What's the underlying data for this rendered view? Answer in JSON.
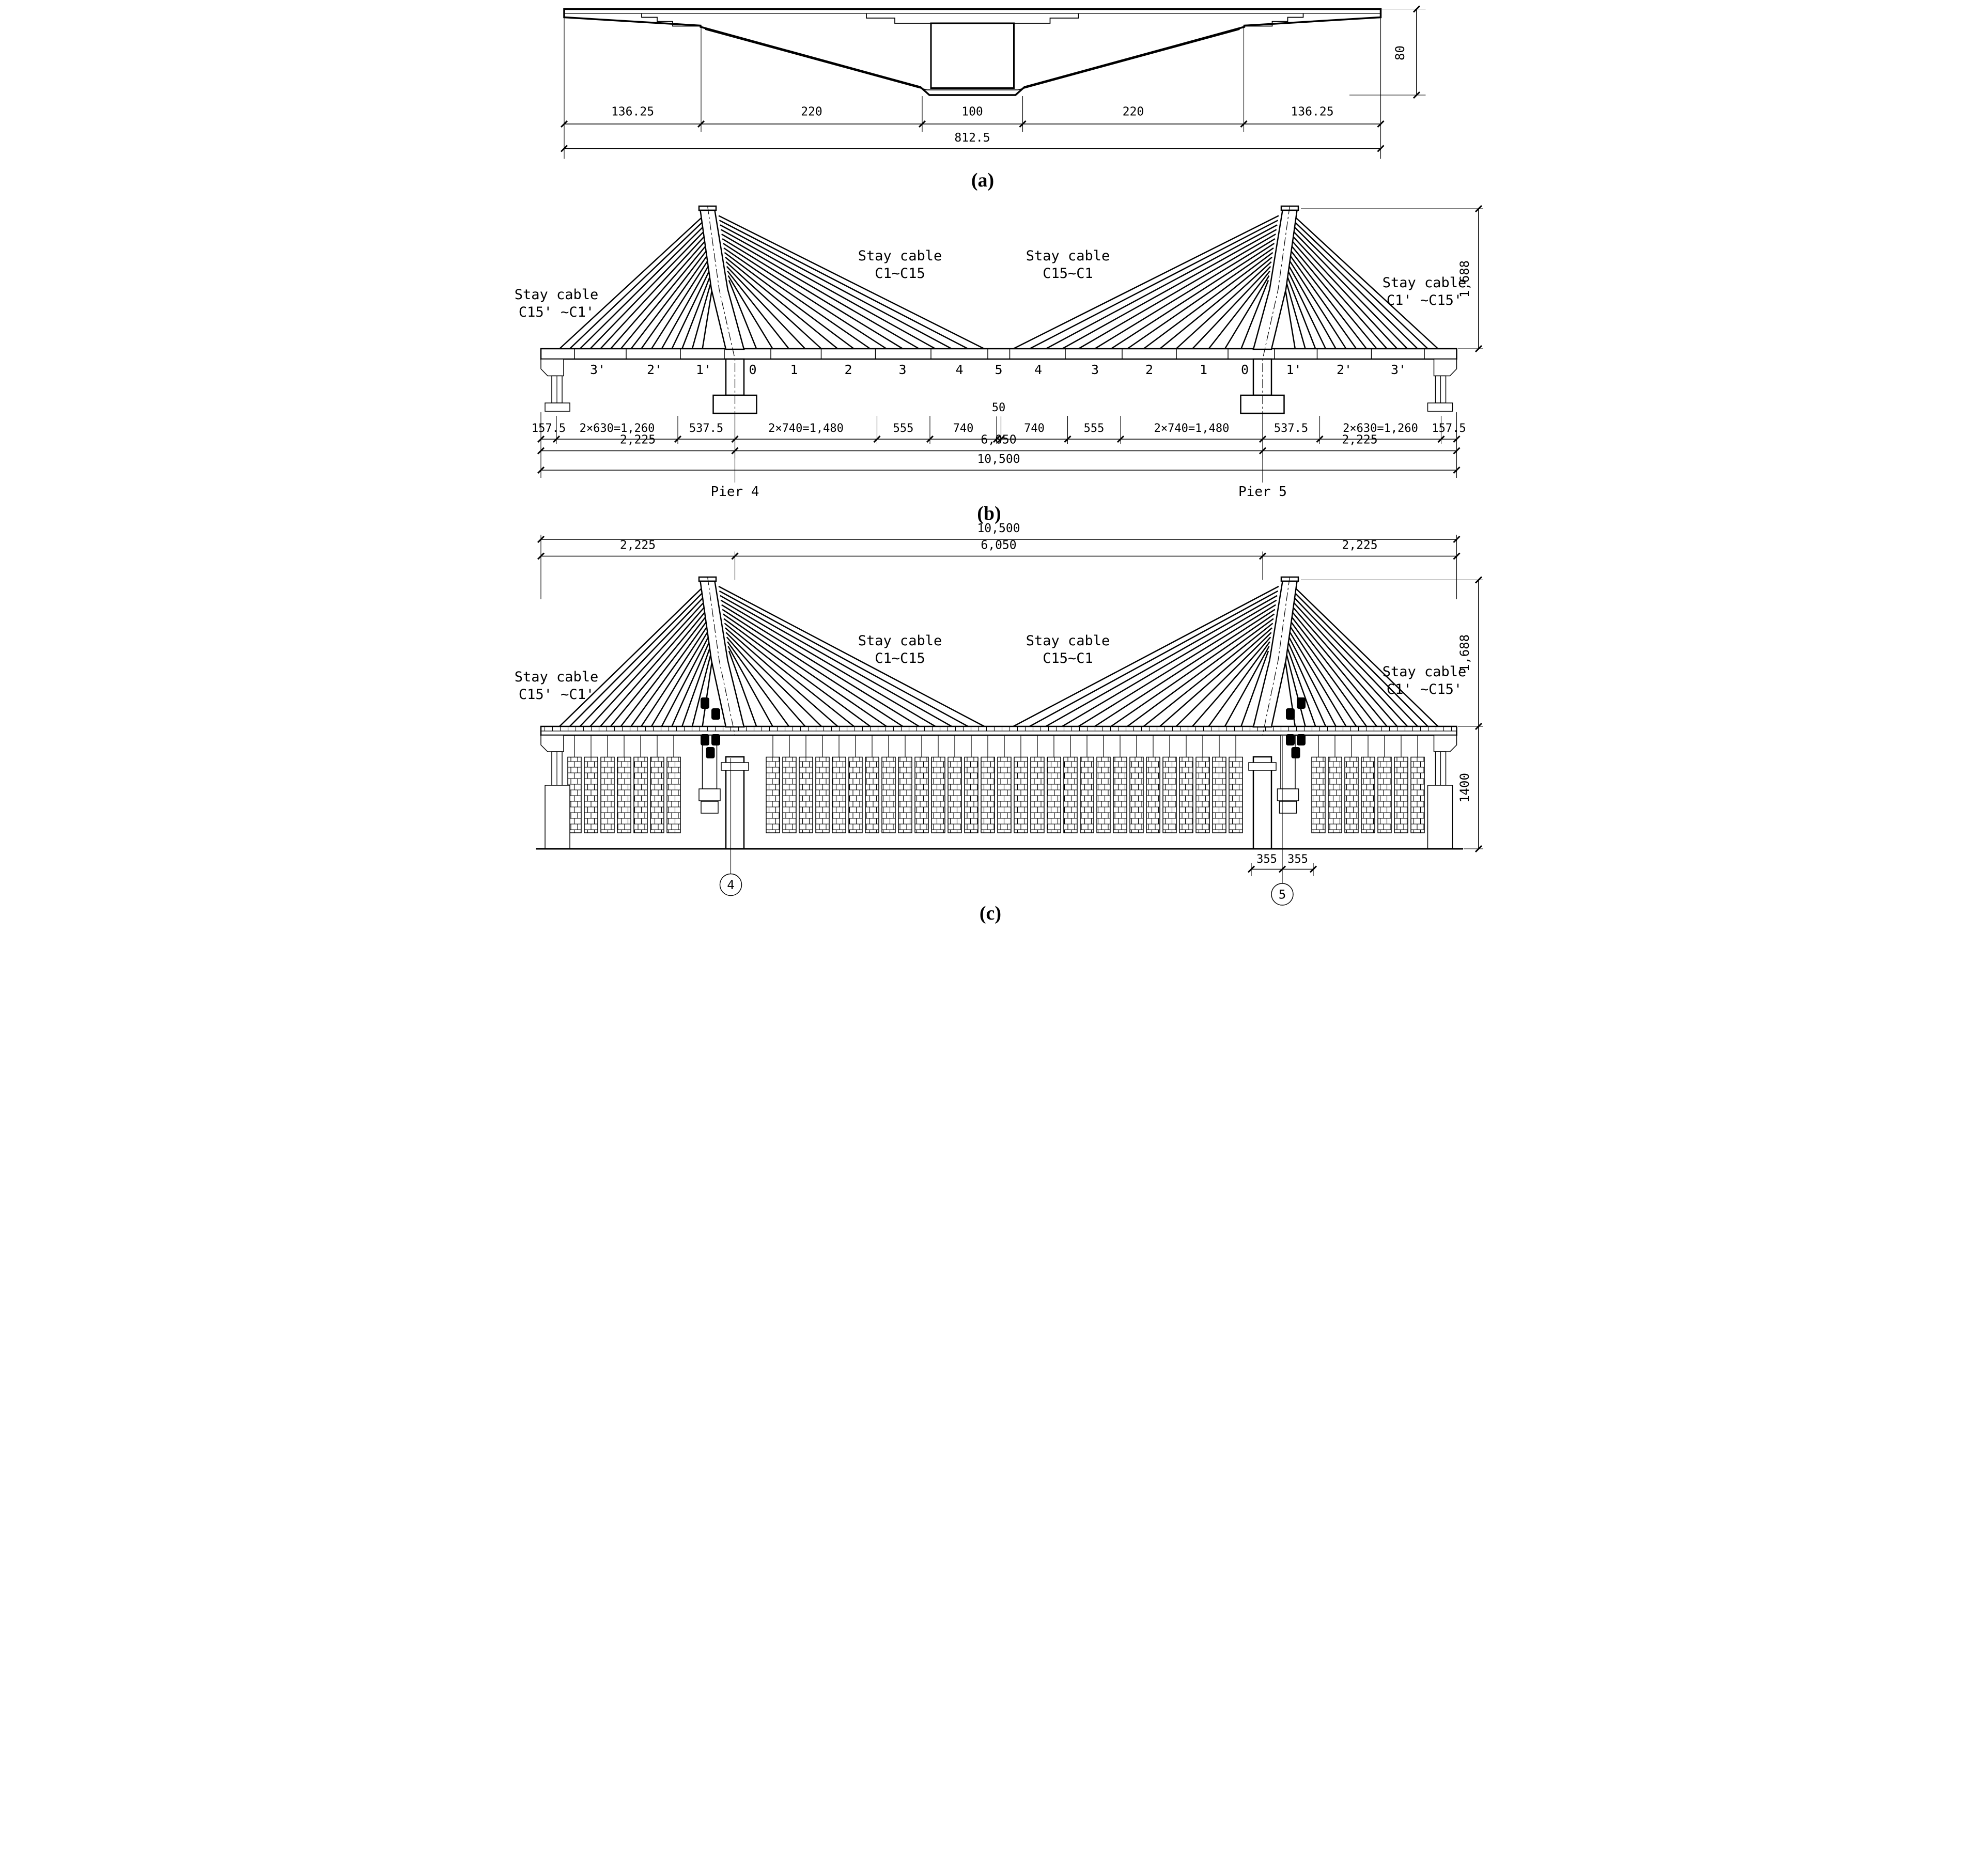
{
  "captions": {
    "a": "(a)",
    "b": "(b)",
    "c": "(c)"
  },
  "panel_a": {
    "dims": [
      "136.25",
      "220",
      "100",
      "220",
      "136.25"
    ],
    "total": "812.5",
    "height": "80"
  },
  "panel_b": {
    "stay": [
      [
        "Stay cable",
        "C15' ~C1'"
      ],
      [
        "Stay cable",
        "C1~C15"
      ],
      [
        "Stay cable",
        "C15~C1"
      ],
      [
        "Stay cable",
        "C1' ~C15'"
      ]
    ],
    "segments": [
      "3'",
      "2'",
      "1'",
      "0",
      "1",
      "2",
      "3",
      "4",
      "5",
      "4",
      "3",
      "2",
      "1",
      "0",
      "1'",
      "2'",
      "3'"
    ],
    "dims_row1": [
      "157.5",
      "2×630=1,260",
      "537.5",
      "2×740=1,480",
      "555",
      "740",
      "50",
      "740",
      "555",
      "2×740=1,480",
      "537.5",
      "2×630=1,260",
      "157.5"
    ],
    "dims_row2": [
      "2,225",
      "6,050",
      "2,225"
    ],
    "total": "10,500",
    "height": "1,688",
    "piers": [
      "Pier 4",
      "Pier 5"
    ]
  },
  "panel_c": {
    "stay": [
      [
        "Stay cable",
        "C15' ~C1'"
      ],
      [
        "Stay cable",
        "C1~C15"
      ],
      [
        "Stay cable",
        "C15~C1"
      ],
      [
        "Stay cable",
        "C1' ~C15'"
      ]
    ],
    "total": "10,500",
    "dims_row2": [
      "2,225",
      "6,050",
      "2,225"
    ],
    "height_upper": "1,688",
    "height_lower": "1400",
    "pier_dims": [
      "355",
      "355"
    ],
    "bubbles": [
      "4",
      "5"
    ]
  }
}
